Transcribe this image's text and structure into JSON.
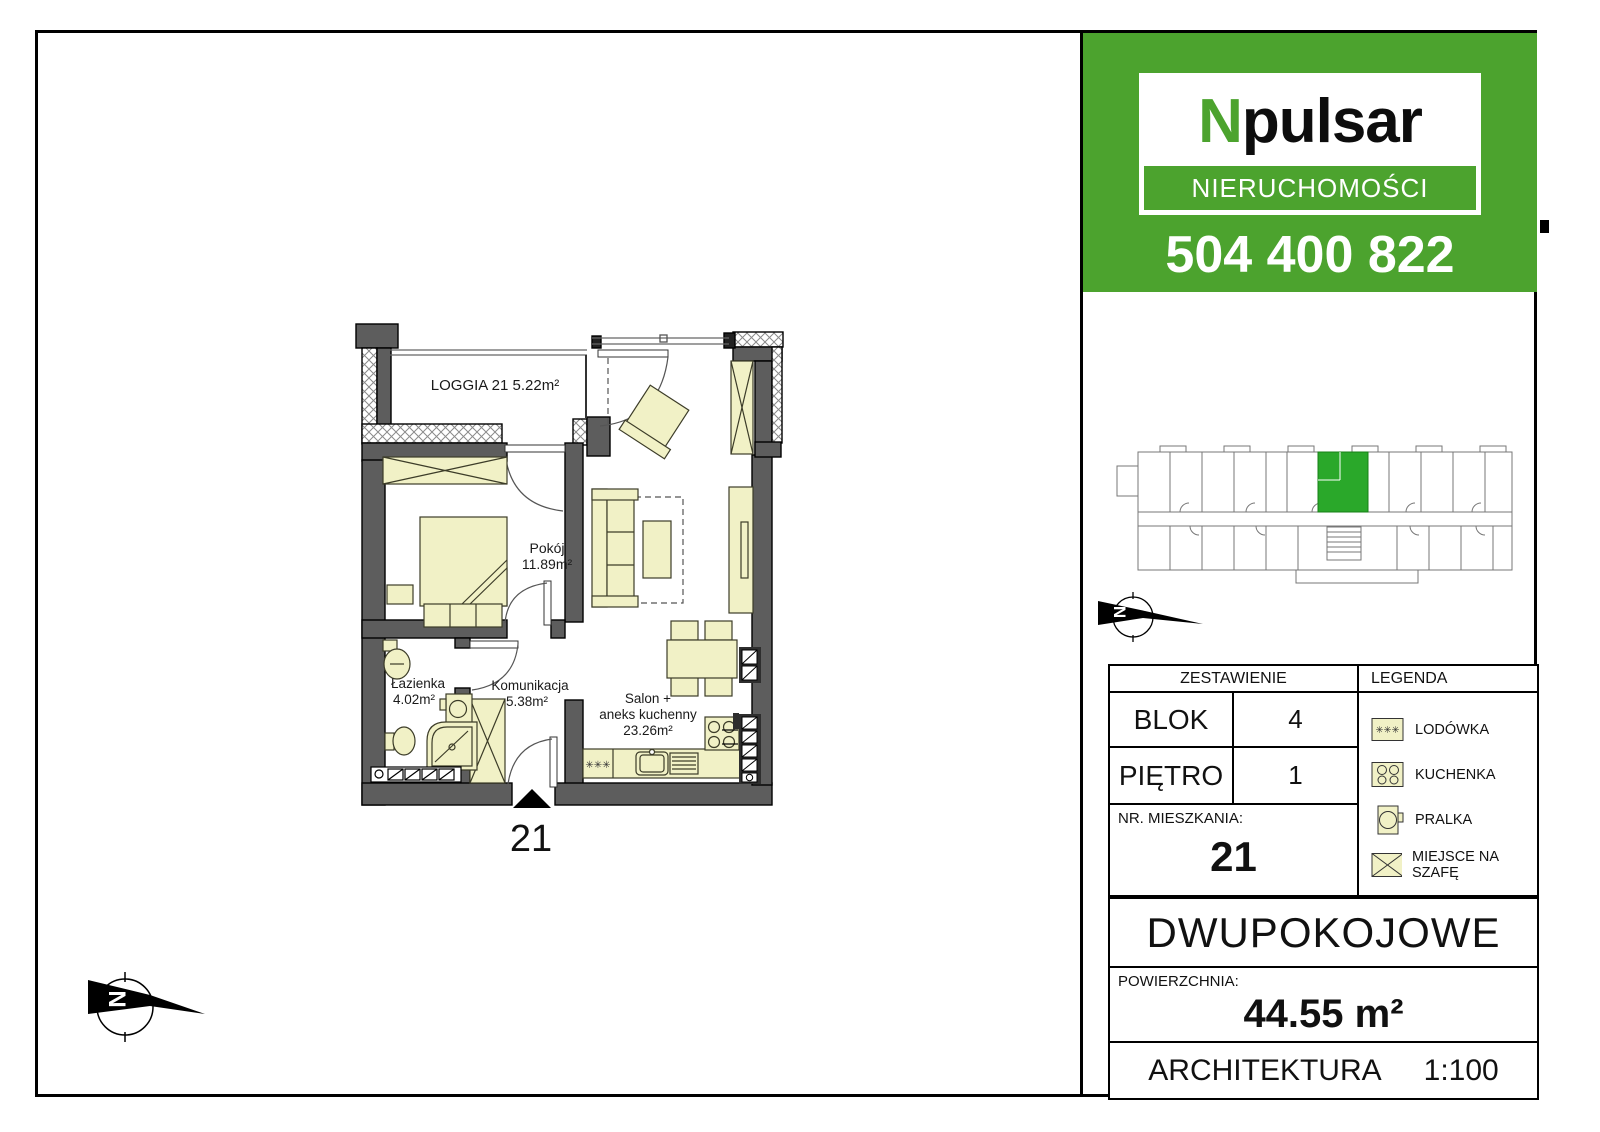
{
  "colors": {
    "brand_green": "#4CA32E",
    "highlight_green": "#2AA82A",
    "furniture": "#F1F1C6",
    "wall_gray": "#5D5D5D"
  },
  "brand": {
    "logo_prefix": "N",
    "logo_suffix": "pulsar",
    "logo_subtitle": "NIERUCHOMOŚCI",
    "phone": "504 400 822"
  },
  "plan": {
    "loggia_label": "LOGGIA 21  5.22m²",
    "rooms": {
      "pokoj": {
        "name": "Pokój",
        "area": "11.89m²"
      },
      "lazienka": {
        "name": "Łazienka",
        "area": "4.02m²"
      },
      "komunikacja": {
        "name": "Komunikacja",
        "area": "5.38m²"
      },
      "salon": {
        "name_line1": "Salon +",
        "name_line2": "aneks kuchenny",
        "area": "23.26m²"
      }
    },
    "entrance_number": "21",
    "fridge_glyphs": "✳✳✳",
    "compass_letter": "N"
  },
  "table": {
    "zestawienie_header": "ZESTAWIENIE",
    "legend_header": "LEGENDA",
    "rows": [
      {
        "label": "BLOK",
        "value": "4"
      },
      {
        "label": "PIĘTRO",
        "value": "1"
      }
    ],
    "apartment_number_label": "NR. MIESZKANIA:",
    "apartment_number": "21",
    "apartment_type": "DWUPOKOJOWE",
    "area_label": "POWIERZCHNIA:",
    "area_value": "44.55 m²",
    "discipline": "ARCHITEKTURA",
    "scale": "1:100"
  },
  "legend": {
    "items": [
      {
        "icon": "fridge-icon",
        "label": "LODÓWKA"
      },
      {
        "icon": "stove-icon",
        "label": "KUCHENKA"
      },
      {
        "icon": "washer-icon",
        "label": "PRALKA"
      },
      {
        "icon": "wardrobe-icon",
        "label": "MIEJSCE NA SZAFĘ"
      }
    ]
  }
}
